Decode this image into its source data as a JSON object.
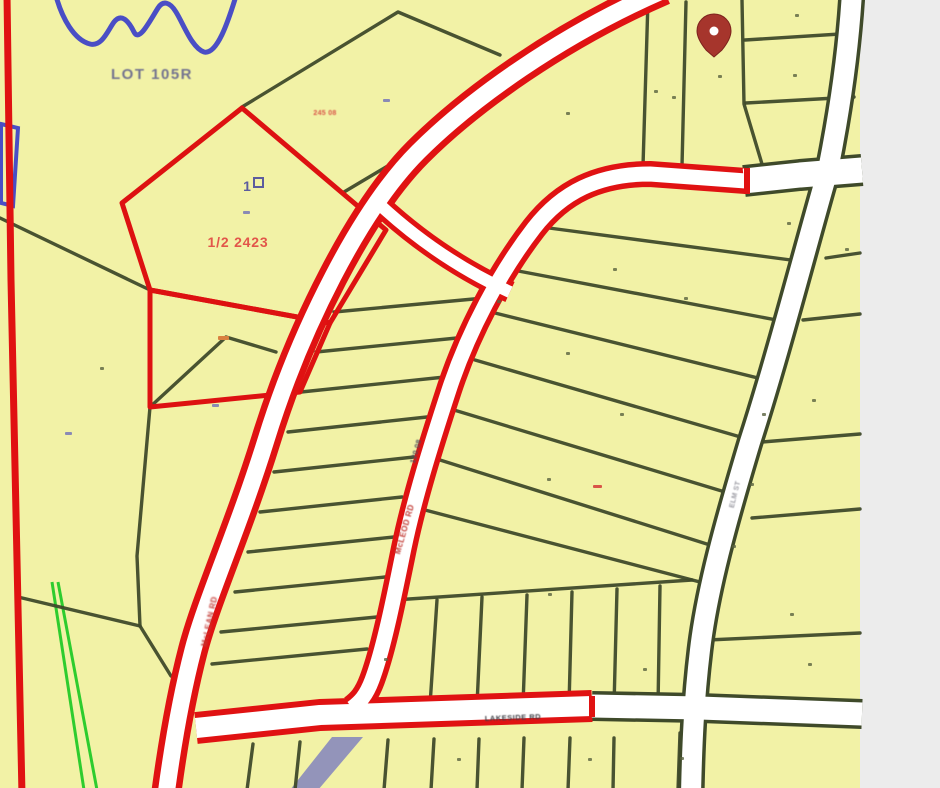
{
  "scene": {
    "width": 940,
    "height": 788,
    "map_width": 860,
    "colors": {
      "parcel_fill": "#f2f2a6",
      "margin_bg": "#ececec",
      "parcel_line": "#3f4a2a",
      "road_highlight": "#e01212",
      "road_lane": "#ffffff",
      "selected_parcel": "#dd1111",
      "creek_blue": "#4a4ec5",
      "stream_lavender": "#9394ba",
      "utility_green": "#2ecc2e",
      "pin_body": "#a6352c",
      "pin_dot": "#ffffff"
    }
  },
  "roads": {
    "highlighted": [
      {
        "name": "main-diagonal-road",
        "d": "M 664,-10 C 560,35 470,100 418,152 C 360,210 300,330 266,440 C 238,530 206,600 193,650 C 180,700 172,750 166,795",
        "casing": 30,
        "lane": 17
      },
      {
        "name": "second-diagonal-road",
        "d": "M 746,181 L 650,174 C 598,174 562,192 534,228 C 500,272 468,332 449,390 C 430,448 414,500 404,548 C 395,592 384,648 372,680 C 366,696 360,702 352,708",
        "casing": 26,
        "lane": 15
      },
      {
        "name": "connector-road",
        "d": "M 380,205 C 420,242 462,270 510,292",
        "casing": 22,
        "lane": 12
      },
      {
        "name": "bottom-road-highlighted",
        "d": "M 196,728 L 320,715 L 592,706",
        "casing": 32,
        "lane": 20
      }
    ],
    "plain": [
      {
        "name": "top-road",
        "d": "M 744,181 L 800,175 L 862,170",
        "casing": 32,
        "lane": 25
      },
      {
        "name": "right-road",
        "d": "M 852,-8 C 848,60 838,120 828,170 C 805,250 778,355 750,442 C 726,522 707,590 700,650 C 694,700 692,745 691,795",
        "casing": 27,
        "lane": 20
      },
      {
        "name": "bottom-road-plain",
        "d": "M 592,706 L 700,708 L 862,714",
        "casing": 30,
        "lane": 23
      }
    ],
    "caps": [
      {
        "x1": 747,
        "y1": 168,
        "x2": 747,
        "y2": 194
      },
      {
        "x1": 592,
        "y1": 696,
        "x2": 592,
        "y2": 717
      }
    ]
  },
  "parcel_lines": [
    [
      0,
      218,
      150,
      290
    ],
    [
      242,
      107,
      398,
      12,
      500,
      55
    ],
    [
      401,
      158,
      344,
      192
    ],
    [
      150,
      407,
      226,
      337,
      276,
      352
    ],
    [
      18,
      597,
      140,
      626
    ],
    [
      150,
      407,
      137,
      556,
      140,
      626
    ],
    [
      140,
      626,
      171,
      676
    ],
    [
      334,
      312,
      495,
      297
    ],
    [
      316,
      352,
      467,
      337
    ],
    [
      301,
      392,
      445,
      377
    ],
    [
      288,
      432,
      427,
      417
    ],
    [
      274,
      472,
      414,
      457
    ],
    [
      260,
      512,
      402,
      497
    ],
    [
      248,
      552,
      394,
      537
    ],
    [
      235,
      592,
      385,
      577
    ],
    [
      221,
      632,
      377,
      617
    ],
    [
      212,
      664,
      367,
      649
    ],
    [
      549,
      228,
      806,
      262
    ],
    [
      513,
      270,
      787,
      322
    ],
    [
      491,
      312,
      766,
      380
    ],
    [
      475,
      360,
      744,
      438
    ],
    [
      454,
      410,
      725,
      492
    ],
    [
      440,
      460,
      710,
      545
    ],
    [
      425,
      510,
      700,
      582
    ],
    [
      394,
      600,
      692,
      580
    ],
    [
      437,
      600,
      430,
      705
    ],
    [
      482,
      597,
      477,
      705
    ],
    [
      527,
      595,
      523,
      705
    ],
    [
      572,
      592,
      569,
      705
    ],
    [
      617,
      589,
      614,
      706
    ],
    [
      660,
      586,
      658,
      706
    ],
    [
      253,
      744,
      247,
      790
    ],
    [
      300,
      742,
      295,
      790
    ],
    [
      388,
      740,
      384,
      790
    ],
    [
      434,
      739,
      431,
      790
    ],
    [
      479,
      739,
      477,
      790
    ],
    [
      524,
      738,
      522,
      790
    ],
    [
      570,
      738,
      568,
      790
    ],
    [
      614,
      738,
      613,
      790
    ],
    [
      648,
      0,
      643,
      166
    ],
    [
      686,
      2,
      682,
      166
    ],
    [
      742,
      0,
      744,
      104,
      762,
      164
    ],
    [
      745,
      40,
      856,
      33
    ],
    [
      746,
      103,
      854,
      97
    ],
    [
      826,
      258,
      860,
      253
    ],
    [
      803,
      320,
      860,
      314
    ],
    [
      762,
      442,
      860,
      434
    ],
    [
      752,
      518,
      860,
      509
    ],
    [
      708,
      640,
      860,
      633
    ],
    [
      680,
      733,
      678,
      790
    ]
  ],
  "red_overlays": {
    "left_line": "M 7,-5 L 11,280 L 17,560 L 22,795",
    "parcels": [
      "M 242,108 L 386,230 L 330,323 L 150,290 L 122,203 Z",
      "M 150,290 L 330,323 L 300,392 L 150,407 Z"
    ]
  },
  "water": {
    "creek": "M 56,-4 C 62,18 74,40 90,44 C 102,47 108,30 114,22 C 121,13 128,20 134,32 C 139,42 148,24 158,8 C 163,0 170,2 176,12 C 184,25 192,48 204,52 C 217,55 228,22 236,-4",
    "blue_rect": "M 1,124 L 18,128 L 13,206 L 1,203 Z",
    "stream_polygon": "332,737 363,737 318,790 290,790"
  },
  "green_lines": [
    [
      52,
      582,
      84,
      790
    ],
    [
      58,
      582,
      97,
      790
    ]
  ],
  "pin": {
    "cx": 714,
    "cy": 31,
    "tip_y": 57
  },
  "parcel_box": {
    "x": 254,
    "y": 178,
    "w": 9,
    "h": 9,
    "color": "#5c5c9e"
  },
  "labels": [
    {
      "text": "LOT 105R",
      "x": 152,
      "y": 79,
      "size": 15,
      "color": "#73738f",
      "weight": "bold",
      "ls": 1.5,
      "rotate": 0,
      "blur": 0.4,
      "illegible": false
    },
    {
      "text": "1/2 2423",
      "x": 238,
      "y": 247,
      "size": 14,
      "color": "#e2564a",
      "weight": "bold",
      "ls": 0.8,
      "rotate": 0,
      "blur": 0.3,
      "illegible": false
    },
    {
      "text": "1",
      "x": 247,
      "y": 191,
      "size": 14,
      "color": "#5c5c9e",
      "weight": "bold",
      "ls": 0,
      "rotate": 0,
      "blur": 0.2,
      "illegible": false
    },
    {
      "text": "245 08",
      "x": 325,
      "y": 115,
      "size": 7,
      "color": "#d95548",
      "weight": "bold",
      "ls": 0.3,
      "rotate": 0,
      "blur": 0.5,
      "illegible": true
    },
    {
      "text": "120.08",
      "x": 418,
      "y": 452,
      "size": 7.5,
      "color": "#50505c",
      "weight": "bold",
      "ls": 0.3,
      "rotate": -74,
      "blur": 0.5,
      "illegible": true
    },
    {
      "text": "McLEOD RD",
      "x": 407,
      "y": 530,
      "size": 8,
      "color": "#c23a34",
      "weight": "bold",
      "ls": 0.5,
      "rotate": -74,
      "blur": 0.6,
      "illegible": true
    },
    {
      "text": "McLEAN RD",
      "x": 212,
      "y": 622,
      "size": 8,
      "color": "#c23a34",
      "weight": "bold",
      "ls": 0.5,
      "rotate": -78,
      "blur": 0.7,
      "illegible": true
    },
    {
      "text": "LAKESIDE RD",
      "x": 513,
      "y": 720,
      "size": 7.5,
      "color": "#3f3f46",
      "weight": "bold",
      "ls": 0.5,
      "rotate": -2,
      "blur": 0.5,
      "illegible": true
    },
    {
      "text": "ELM ST",
      "x": 737,
      "y": 495,
      "size": 7,
      "color": "#9a9aa2",
      "weight": "bold",
      "ls": 0.3,
      "rotate": -76,
      "blur": 0.5,
      "illegible": true
    }
  ],
  "dots": {
    "olive": [
      [
        718,
        75
      ],
      [
        793,
        74
      ],
      [
        795,
        14
      ],
      [
        845,
        248
      ],
      [
        787,
        222
      ],
      [
        672,
        96
      ],
      [
        654,
        90
      ],
      [
        566,
        112
      ],
      [
        497,
        300
      ],
      [
        613,
        268
      ],
      [
        684,
        297
      ],
      [
        566,
        352
      ],
      [
        620,
        413
      ],
      [
        812,
        399
      ],
      [
        762,
        413
      ],
      [
        750,
        483
      ],
      [
        790,
        613
      ],
      [
        643,
        668
      ],
      [
        548,
        593
      ],
      [
        384,
        658
      ],
      [
        100,
        367
      ],
      [
        547,
        478
      ],
      [
        732,
        545
      ],
      [
        808,
        663
      ],
      [
        588,
        758
      ],
      [
        680,
        757
      ],
      [
        457,
        758
      ]
    ],
    "blue_dashes": [
      [
        383,
        99
      ],
      [
        243,
        211
      ],
      [
        212,
        404
      ],
      [
        65,
        432
      ]
    ],
    "red_marks": [
      {
        "x": 218,
        "y": 336,
        "w": 11,
        "h": 4,
        "color": "#d98040"
      },
      {
        "x": 593,
        "y": 485,
        "w": 9,
        "h": 3,
        "color": "#d95548"
      }
    ]
  }
}
